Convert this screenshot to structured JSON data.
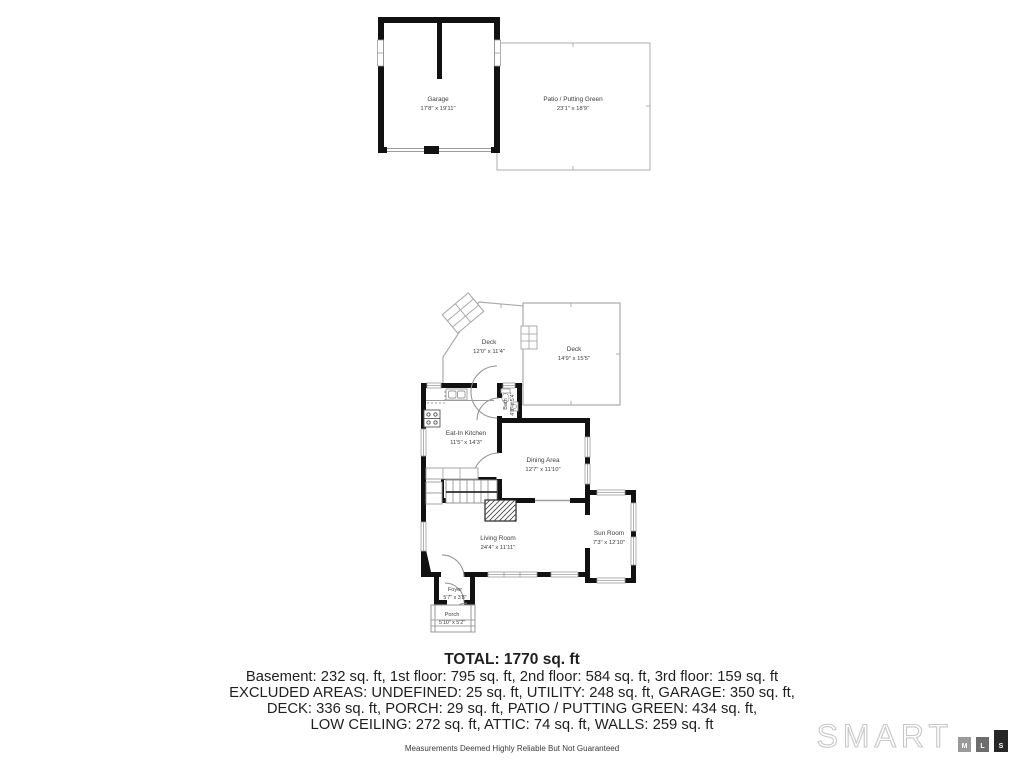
{
  "rooms": {
    "garage": {
      "name": "Garage",
      "dims": "17'8\" x 19'11\""
    },
    "patio": {
      "name": "Patio / Putting Green",
      "dims": "23'1\" x 18'9\""
    },
    "deck_left": {
      "name": "Deck",
      "dims": "12'0\" x 11'4\""
    },
    "deck_right": {
      "name": "Deck",
      "dims": "14'9\" x 15'5\""
    },
    "bath": {
      "name": "Bath",
      "dims": "4'9\" x 5'4\""
    },
    "kitchen": {
      "name": "Eat-In Kitchen",
      "dims": "11'5\" x 14'3\""
    },
    "dining": {
      "name": "Dining Area",
      "dims": "12'7\" x 11'10\""
    },
    "living": {
      "name": "Living Room",
      "dims": "24'4\" x 11'11\""
    },
    "sunroom": {
      "name": "Sun Room",
      "dims": "7'3\" x 12'10\""
    },
    "foyer": {
      "name": "Foyer",
      "dims": "5'7\" x 3'8\""
    },
    "porch": {
      "name": "Porch",
      "dims": "5'10\" x 5'2\""
    }
  },
  "summary": {
    "total": "TOTAL: 1770 sq. ft",
    "line1": "Basement: 232 sq. ft, 1st floor: 795 sq. ft, 2nd floor: 584 sq. ft, 3rd floor: 159 sq. ft",
    "line2": "EXCLUDED AREAS: UNDEFINED: 25 sq. ft, UTILITY: 248 sq. ft, GARAGE: 350 sq. ft,",
    "line3": "DECK: 336 sq. ft, PORCH: 29 sq. ft, PATIO / PUTTING GREEN: 434 sq. ft,",
    "line4": "LOW CEILING: 272 sq. ft, ATTIC: 74 sq. ft, WALLS: 259 sq. ft"
  },
  "disclaimer": "Measurements Deemed Highly Reliable But Not Guaranteed",
  "logo": {
    "brand": "SMART",
    "m": "M",
    "l": "L",
    "s": "S"
  },
  "colors": {
    "wall": "#111111",
    "thin_line": "#ababab",
    "label": "#3d3d3d",
    "logo_outline": "#c7c7c7",
    "logo_block_m": "#9a9a9a",
    "logo_block_l": "#6d6d6d",
    "logo_block_s": "#262626"
  }
}
